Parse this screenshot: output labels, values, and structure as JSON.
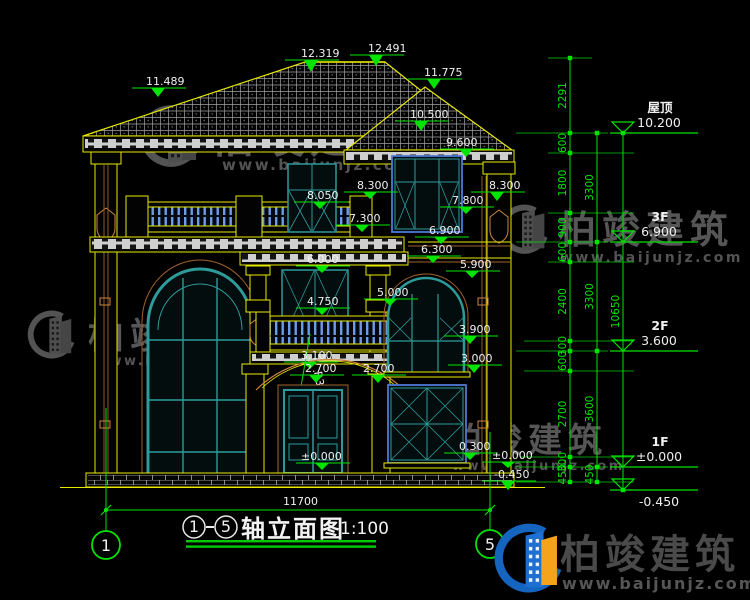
{
  "page": {
    "background": "#000000"
  },
  "colors": {
    "yellow": "#e8e800",
    "green": "#00e400",
    "teal": "#2e9b9b",
    "blue": "#4d79d6",
    "brown": "#a0622d",
    "trim": "#cd853f",
    "white": "#f0f0f0",
    "watermark_gray": "#a0a0a0",
    "logo_blue": "#1565c0",
    "logo_blue2": "#1d6fd1",
    "logo_orange": "#f5a31a",
    "logo_text": "#4a4a4a",
    "underline_green": "#00cc00"
  },
  "drawing": {
    "title": {
      "axis_start": "1",
      "axis_end": "5",
      "name": "轴立面图",
      "scale": "1:100"
    },
    "overall_width_dim": "11700",
    "radius_label": "R3012",
    "axis_bubbles": [
      {
        "label": "1",
        "cx": 106,
        "cy": 545
      },
      {
        "label": "5",
        "cx": 490,
        "cy": 544
      }
    ],
    "spot_elevations": [
      {
        "v": "11.489",
        "x": 158,
        "y": 97,
        "tx": 146,
        "ty": 85
      },
      {
        "v": "12.319",
        "x": 311,
        "y": 72,
        "tx": 301,
        "ty": 57
      },
      {
        "v": "12.491",
        "x": 376,
        "y": 66,
        "tx": 368,
        "ty": 52
      },
      {
        "v": "11.775",
        "x": 434,
        "y": 89,
        "tx": 424,
        "ty": 76
      },
      {
        "v": "10.500",
        "x": 421,
        "y": 131,
        "tx": 410,
        "ty": 118
      },
      {
        "v": "9.600",
        "x": 466,
        "y": 157,
        "tx": 446,
        "ty": 146
      },
      {
        "v": "8.050",
        "x": 320,
        "y": 209,
        "tx": 307,
        "ty": 199
      },
      {
        "v": "8.300",
        "x": 370,
        "y": 199,
        "tx": 357,
        "ty": 189
      },
      {
        "v": "8.300",
        "x": 497,
        "y": 201,
        "tx": 489,
        "ty": 189
      },
      {
        "v": "7.800",
        "x": 466,
        "y": 214,
        "tx": 452,
        "ty": 204
      },
      {
        "v": "7.300",
        "x": 362,
        "y": 232,
        "tx": 349,
        "ty": 222
      },
      {
        "v": "6.900",
        "x": 441,
        "y": 244,
        "tx": 429,
        "ty": 234
      },
      {
        "v": "6.300",
        "x": 433,
        "y": 263,
        "tx": 421,
        "ty": 253
      },
      {
        "v": "6.000",
        "x": 322,
        "y": 273,
        "tx": 307,
        "ty": 263
      },
      {
        "v": "5.900",
        "x": 472,
        "y": 278,
        "tx": 460,
        "ty": 268
      },
      {
        "v": "5.000",
        "x": 390,
        "y": 306,
        "tx": 377,
        "ty": 296
      },
      {
        "v": "4.750",
        "x": 322,
        "y": 315,
        "tx": 307,
        "ty": 305
      },
      {
        "v": "3.900",
        "x": 470,
        "y": 344,
        "tx": 459,
        "ty": 333
      },
      {
        "v": "3.100",
        "x": 310,
        "y": 369,
        "tx": 301,
        "ty": 359
      },
      {
        "v": "3.000",
        "x": 474,
        "y": 373,
        "tx": 461,
        "ty": 362
      },
      {
        "v": "2.700",
        "x": 316,
        "y": 383,
        "tx": 305,
        "ty": 372
      },
      {
        "v": "2.700",
        "x": 378,
        "y": 383,
        "tx": 363,
        "ty": 372
      },
      {
        "v": "0.300",
        "x": 470,
        "y": 460,
        "tx": 459,
        "ty": 450
      },
      {
        "v": "±0.000",
        "x": 322,
        "y": 470,
        "tx": 301,
        "ty": 460
      },
      {
        "v": "±0.000",
        "x": 508,
        "y": 468,
        "tx": 492,
        "ty": 459
      },
      {
        "v": "-0.450",
        "x": 508,
        "y": 490,
        "tx": 494,
        "ty": 478
      }
    ],
    "floor_markers": [
      {
        "name": "屋顶",
        "value": "10.200",
        "y": 133
      },
      {
        "name": "3F",
        "value": "6.900",
        "y": 242
      },
      {
        "name": "2F",
        "value": "3.600",
        "y": 351
      },
      {
        "name": "1F",
        "value": "±0.000",
        "y": 467
      },
      {
        "name": "",
        "value": "-0.450",
        "y": 490
      }
    ],
    "dim_chains": [
      {
        "x": 570,
        "ticks": [
          58,
          133,
          153,
          213,
          242,
          262,
          341,
          351,
          371,
          457,
          467,
          482
        ],
        "labels": [
          "2291",
          "600",
          "1800",
          "900",
          "600",
          "2400",
          "300",
          "600",
          "2700",
          "300",
          "450"
        ]
      },
      {
        "x": 597,
        "ticks": [
          133,
          242,
          351,
          467,
          482
        ],
        "labels": [
          "3300",
          "3300",
          "3600",
          "450"
        ]
      },
      {
        "x": 623,
        "ticks": [
          133,
          490
        ],
        "labels": [
          "10650"
        ]
      }
    ],
    "ext_lines": [
      [
        548,
        58,
        592
      ],
      [
        516,
        133,
        608
      ],
      [
        548,
        153,
        634
      ],
      [
        548,
        213,
        634
      ],
      [
        516,
        242,
        608
      ],
      [
        548,
        262,
        634
      ],
      [
        524,
        341,
        634
      ],
      [
        516,
        351,
        608
      ],
      [
        524,
        371,
        634
      ],
      [
        520,
        457,
        634
      ],
      [
        516,
        467,
        608
      ],
      [
        516,
        482,
        634
      ]
    ]
  },
  "watermark": {
    "brand": "柏竣建筑",
    "url": "www.baijunjz.com",
    "instances": [
      {
        "gx": 138,
        "gy": 102,
        "gs": 1.0,
        "bx": 210,
        "by": 152,
        "bf": 44,
        "ux": 222,
        "uy": 170,
        "uf": 15
      },
      {
        "gx": 26,
        "gy": 308,
        "gs": 0.78,
        "bx": 88,
        "by": 348,
        "bf": 36,
        "ux": 95,
        "uy": 365,
        "uf": 13
      },
      {
        "gx": 498,
        "gy": 202,
        "gs": 0.8,
        "bx": 558,
        "by": 243,
        "bf": 38,
        "ux": 560,
        "uy": 262,
        "uf": 14
      },
      {
        "gx": 384,
        "gy": 415,
        "gs": 0.8,
        "bx": 448,
        "by": 452,
        "bf": 34,
        "ux": 452,
        "uy": 470,
        "uf": 13
      }
    ]
  },
  "logo": {
    "brand": "柏竣建筑",
    "url": "www.baijunjz.com"
  }
}
